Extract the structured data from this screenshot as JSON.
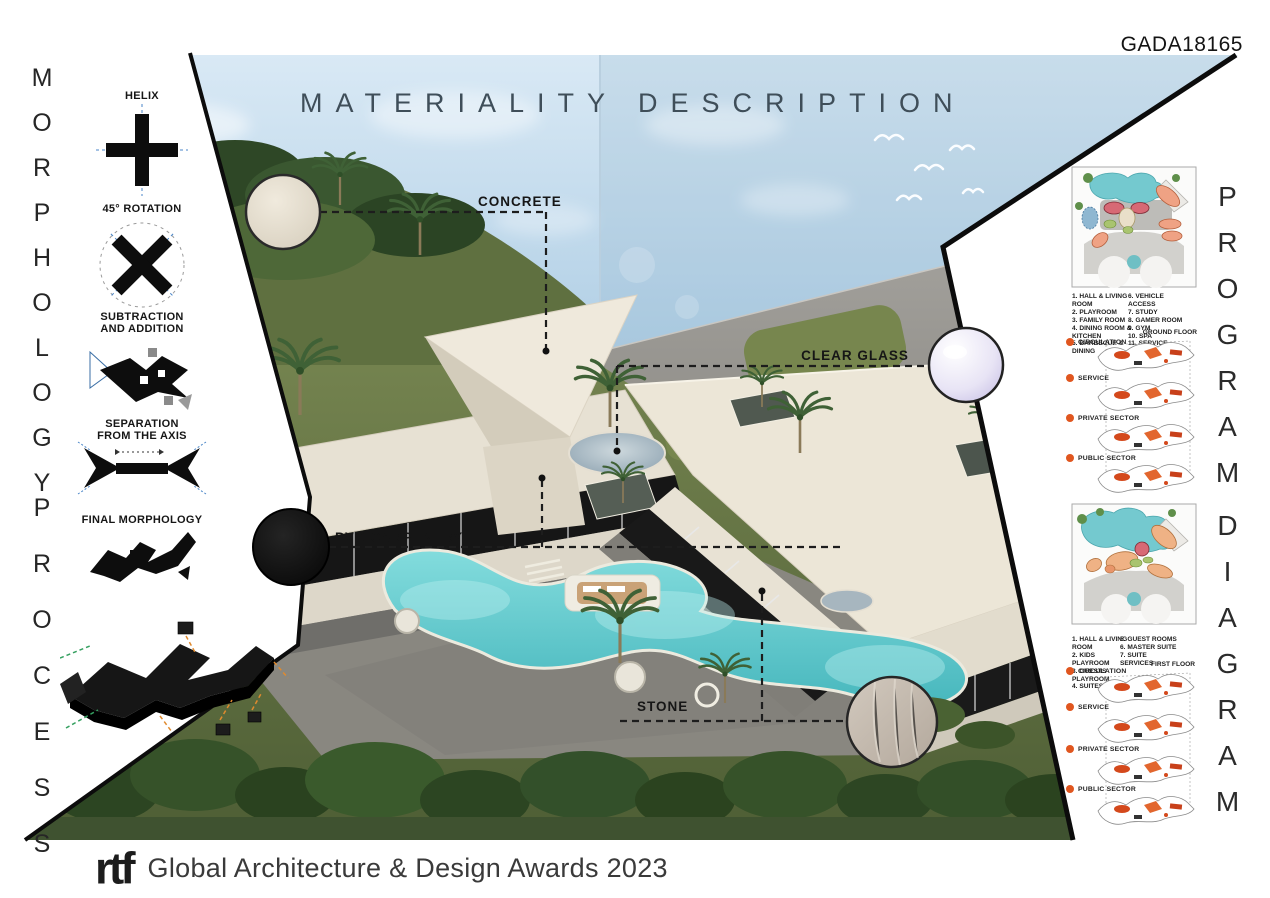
{
  "header": {
    "code": "GADA18165",
    "title": "MATERIALITY DESCRIPTION"
  },
  "footer": {
    "logo_text": "rtf",
    "award_text": "Global Architecture & Design Awards 2023"
  },
  "morphology": {
    "title_word1": "MORPHOLOGY",
    "title_word2": "PROCESS",
    "step1_label": "HELIX",
    "step2_label": "45° ROTATION",
    "step3_label_line1": "SUBTRACTION",
    "step3_label_line2": "AND ADDITION",
    "step4_label_line1": "SEPARATION",
    "step4_label_line2": "FROM THE AXIS",
    "step5_label": "FINAL MORPHOLOGY"
  },
  "materials": {
    "concrete": "CONCRETE",
    "clear_glass": "CLEAR GLASS",
    "pvc_carpentry": "PVC CARPENTRY",
    "stone": "STONE"
  },
  "program": {
    "title_word1": "PROGRAM",
    "title_word2": "DIAGRAM",
    "sectors": [
      "CIRCULATION",
      "SERVICE",
      "PRIVATE SECTOR",
      "PUBLIC SECTOR"
    ],
    "ground_floor": {
      "floor_label": "GROUND FLOOR",
      "legend_left": [
        "1. HALL & LIVING ROOM",
        "2. PLAYROOM",
        "3. FAMILY ROOM",
        "4. DINING ROOM & KITCHEN",
        "5. BARBECUE & DINING"
      ],
      "legend_right": [
        "6. VEHICLE ACCESS",
        "7. STUDY",
        "8. GAMER ROOM",
        "9. GYM",
        "10. SPA",
        "11. SERVICE"
      ]
    },
    "first_floor": {
      "floor_label": "FIRST FLOOR",
      "legend_left": [
        "1. HALL & LIVING ROOM",
        "2. KIDS PLAYROOM",
        "3. GUESTS PLAYROOM",
        "4. SUITES"
      ],
      "legend_right": [
        "5. GUEST ROOMS",
        "6. MASTER SUITE",
        "7. SUITE SERVICES"
      ]
    }
  },
  "icons": {
    "sector_dot": "●",
    "helix_icon": "cross-shape",
    "rotation_icon": "rotated-cross",
    "material_swatch": "circle-swatch"
  },
  "colors": {
    "sector_accent": "#e0561f",
    "pool": "#5fc8cb",
    "sky": "#bcd6ea",
    "roof_cream": "#ebe5d7",
    "panel_edge": "#0c0c0c"
  }
}
